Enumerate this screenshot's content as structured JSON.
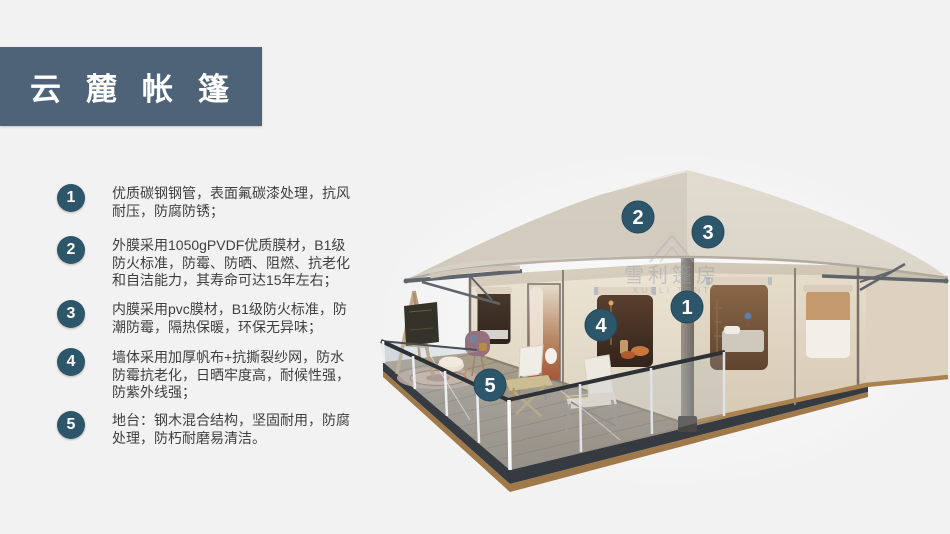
{
  "header": {
    "title": "云麓帐篷"
  },
  "features": [
    {
      "num": "1",
      "text": "优质碳钢钢管，表面氟碳漆处理，抗风耐压，防腐防锈；"
    },
    {
      "num": "2",
      "text": "外膜采用1050gPVDF优质膜材，B1级防火标准，防霉、防晒、阻燃、抗老化和自洁能力，其寿命可达15年左右；"
    },
    {
      "num": "3",
      "text": "内膜采用pvc膜材，B1级防火标准，防潮防霉，隔热保暖，环保无异味；"
    },
    {
      "num": "4",
      "text": "墙体采用加厚帆布+抗撕裂纱网，防水防霉抗老化，日晒牢度高，耐候性强，防紫外线强；"
    },
    {
      "num": "5",
      "text": "地台：钢木混合结构，坚固耐用，防腐处理，防朽耐磨易清洁。"
    }
  ],
  "diagram": {
    "markers": [
      {
        "label": "1"
      },
      {
        "label": "2"
      },
      {
        "label": "3"
      },
      {
        "label": "4"
      },
      {
        "label": "5"
      }
    ],
    "watermark": {
      "cn": "雪利篷房",
      "en": "XUELI TENT"
    }
  },
  "colors": {
    "title_bg": "#4e6378",
    "badge": "#2d566b",
    "background": "#f2f2f3",
    "canopy": "#dad3c7",
    "wall": "#e7dfcf",
    "deck_fascia": "#363b41",
    "deck_wood_trim": "#a0794a"
  }
}
